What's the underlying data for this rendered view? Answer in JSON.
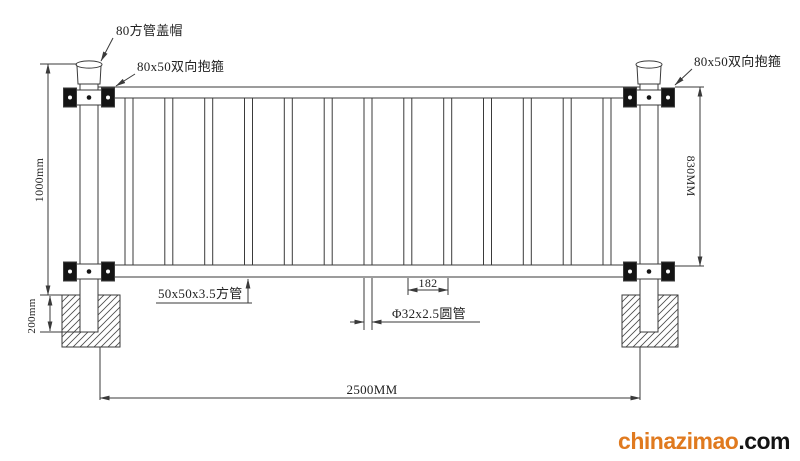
{
  "title": "guardrail-fence-technical-drawing",
  "labels": {
    "cap": "80方管盖帽",
    "clamp_left": "80x50双向抱箍",
    "clamp_right": "80x50双向抱箍",
    "square_tube": "50x50x3.5方管",
    "round_tube": "Φ32x2.5圆管"
  },
  "dimensions": {
    "height_total": "1000mm",
    "rail_height": "830MM",
    "embed_depth": "200mm",
    "span_width": "2500MM",
    "picket_gap": "182"
  },
  "fence": {
    "picket_count": 13
  },
  "colors": {
    "line": "#3a3a3a",
    "text": "#222222"
  },
  "watermark": {
    "brand": "chinazimao",
    "suffix": ".com",
    "brand_color": "#e07a1f",
    "suffix_color": "#141414"
  }
}
